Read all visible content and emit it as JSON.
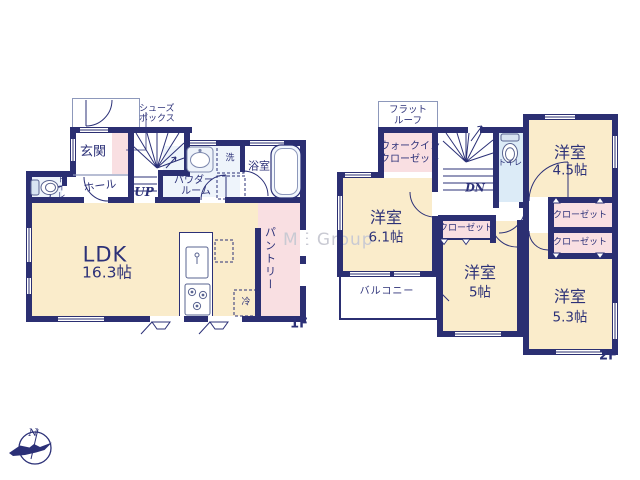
{
  "watermark": "ME Group",
  "compass": {
    "north_label": "N"
  },
  "colors": {
    "wall": "#2b2f72",
    "text": "#2c3178",
    "room_cream": "#faeccb",
    "closet_pink": "#f9dfe2",
    "wet_area_blue": "#dcebf7",
    "watermark_gray": "#c9cad3"
  },
  "floor1": {
    "floor_label": "1F",
    "genkan_label": "玄関",
    "shoes_box_lines": [
      "シューズ",
      "ボックス"
    ],
    "hall_label": "ホール",
    "toilet_label": "トイレ",
    "stairs_label": "UP",
    "powder_room_lines": [
      "パウダー",
      "ルーム"
    ],
    "laundry_label": "洗",
    "bath_label": "浴室",
    "ldk_label": "LDK",
    "ldk_size": "16.3帖",
    "pantry_label": "パントリー",
    "fridge_label": "冷"
  },
  "floor2": {
    "floor_label": "2F",
    "flat_roof_lines": [
      "フラット",
      "ルーフ"
    ],
    "wic_lines": [
      "ウォークイン",
      "クローゼット"
    ],
    "stairs_label": "DN",
    "toilet_label": "トイレ",
    "room_45": {
      "type": "洋室",
      "size": "4.5帖"
    },
    "room_61": {
      "type": "洋室",
      "size": "6.1帖"
    },
    "room_5": {
      "type": "洋室",
      "size": "5帖"
    },
    "room_53": {
      "type": "洋室",
      "size": "5.3帖"
    },
    "closet_labels": [
      "クローゼット",
      "クローゼット",
      "クローゼット"
    ],
    "balcony_label": "バルコニー"
  }
}
